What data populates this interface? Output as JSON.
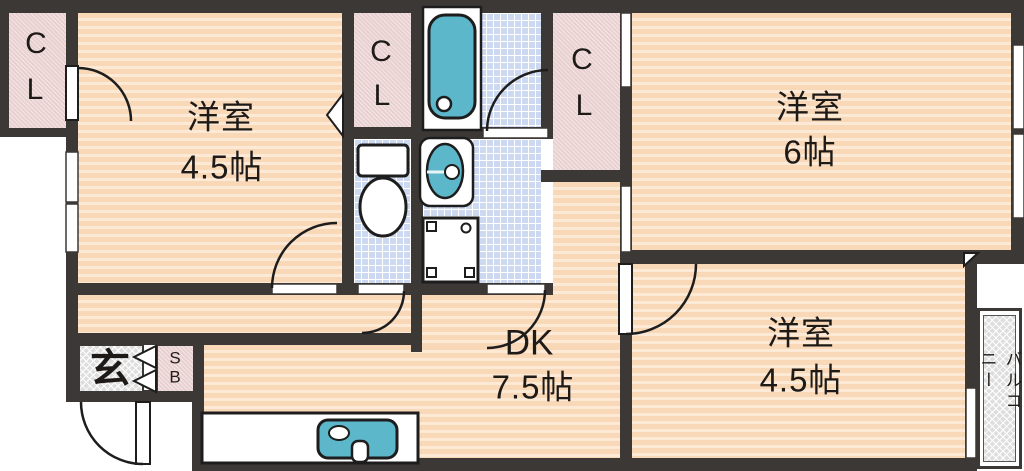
{
  "rooms": {
    "western_room_1": {
      "name": "洋室",
      "size": "4.5帖"
    },
    "western_room_2": {
      "name": "洋室",
      "size": "6帖"
    },
    "western_room_3": {
      "name": "洋室",
      "size": "4.5帖"
    },
    "dining_kitchen": {
      "name": "DK",
      "size": "7.5帖"
    }
  },
  "closets": {
    "cl_top_left": [
      "C",
      "L"
    ],
    "cl_middle": [
      "C",
      "L"
    ],
    "cl_right": [
      "C",
      "L"
    ]
  },
  "entrance": {
    "label": "玄"
  },
  "shoe_box": {
    "letters": [
      "S",
      "B"
    ]
  },
  "balcony": {
    "label": "バルコニー"
  },
  "icons": [
    "bathtub",
    "toilet",
    "washbasin",
    "washing-machine-pan",
    "kitchen-sink",
    "door-swing-arc",
    "window",
    "folding-door"
  ],
  "colors": {
    "wall": "#3c3836",
    "floor_base": "#f8d8b6",
    "floor_stripe": "#fcead7",
    "closet_pink": "#e9d0d0",
    "wet_area_tile": "#ccd9f1",
    "fixture_teal": "#5cb7ca",
    "hatch_gray": "#dedede",
    "outline": "#1d1d1d"
  }
}
